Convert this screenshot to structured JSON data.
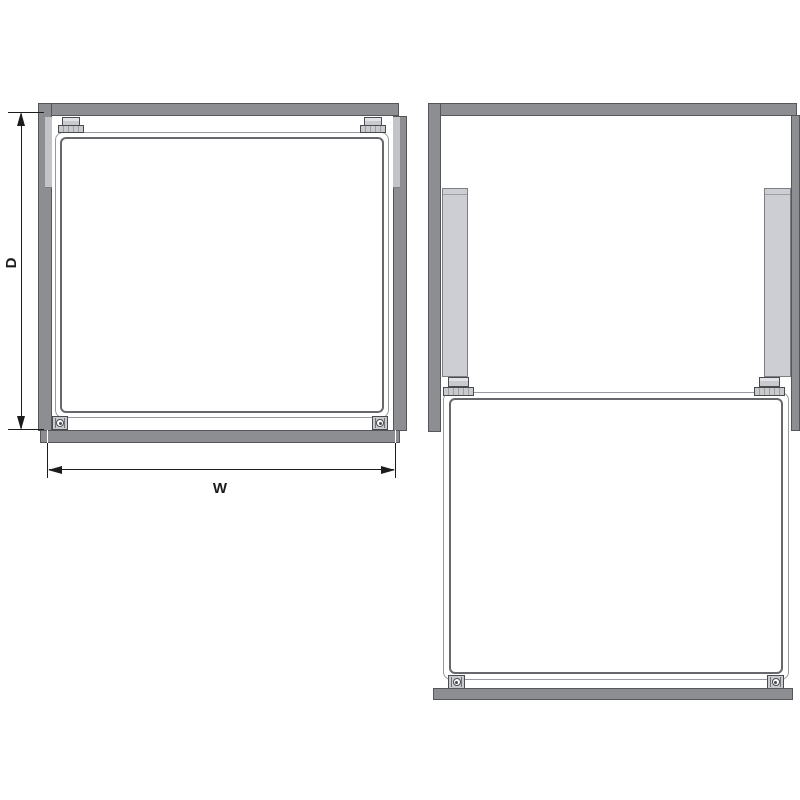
{
  "labels": {
    "depth": "D",
    "width": "W"
  },
  "colors": {
    "background": "#ffffff",
    "frame": "#8d8e92",
    "frame_border": "#55565a",
    "rail": "#cdced3",
    "rail_border": "#7e7f84",
    "rail_strip": "#c3c4c8",
    "panel_fill": "#ffffff",
    "panel_border_outer": "#98999c",
    "panel_border_inner": "#67686b",
    "fitting_fill": "#c9cacd",
    "fitting_border": "#4a4b4e",
    "dimension": "#1c1c1e"
  }
}
